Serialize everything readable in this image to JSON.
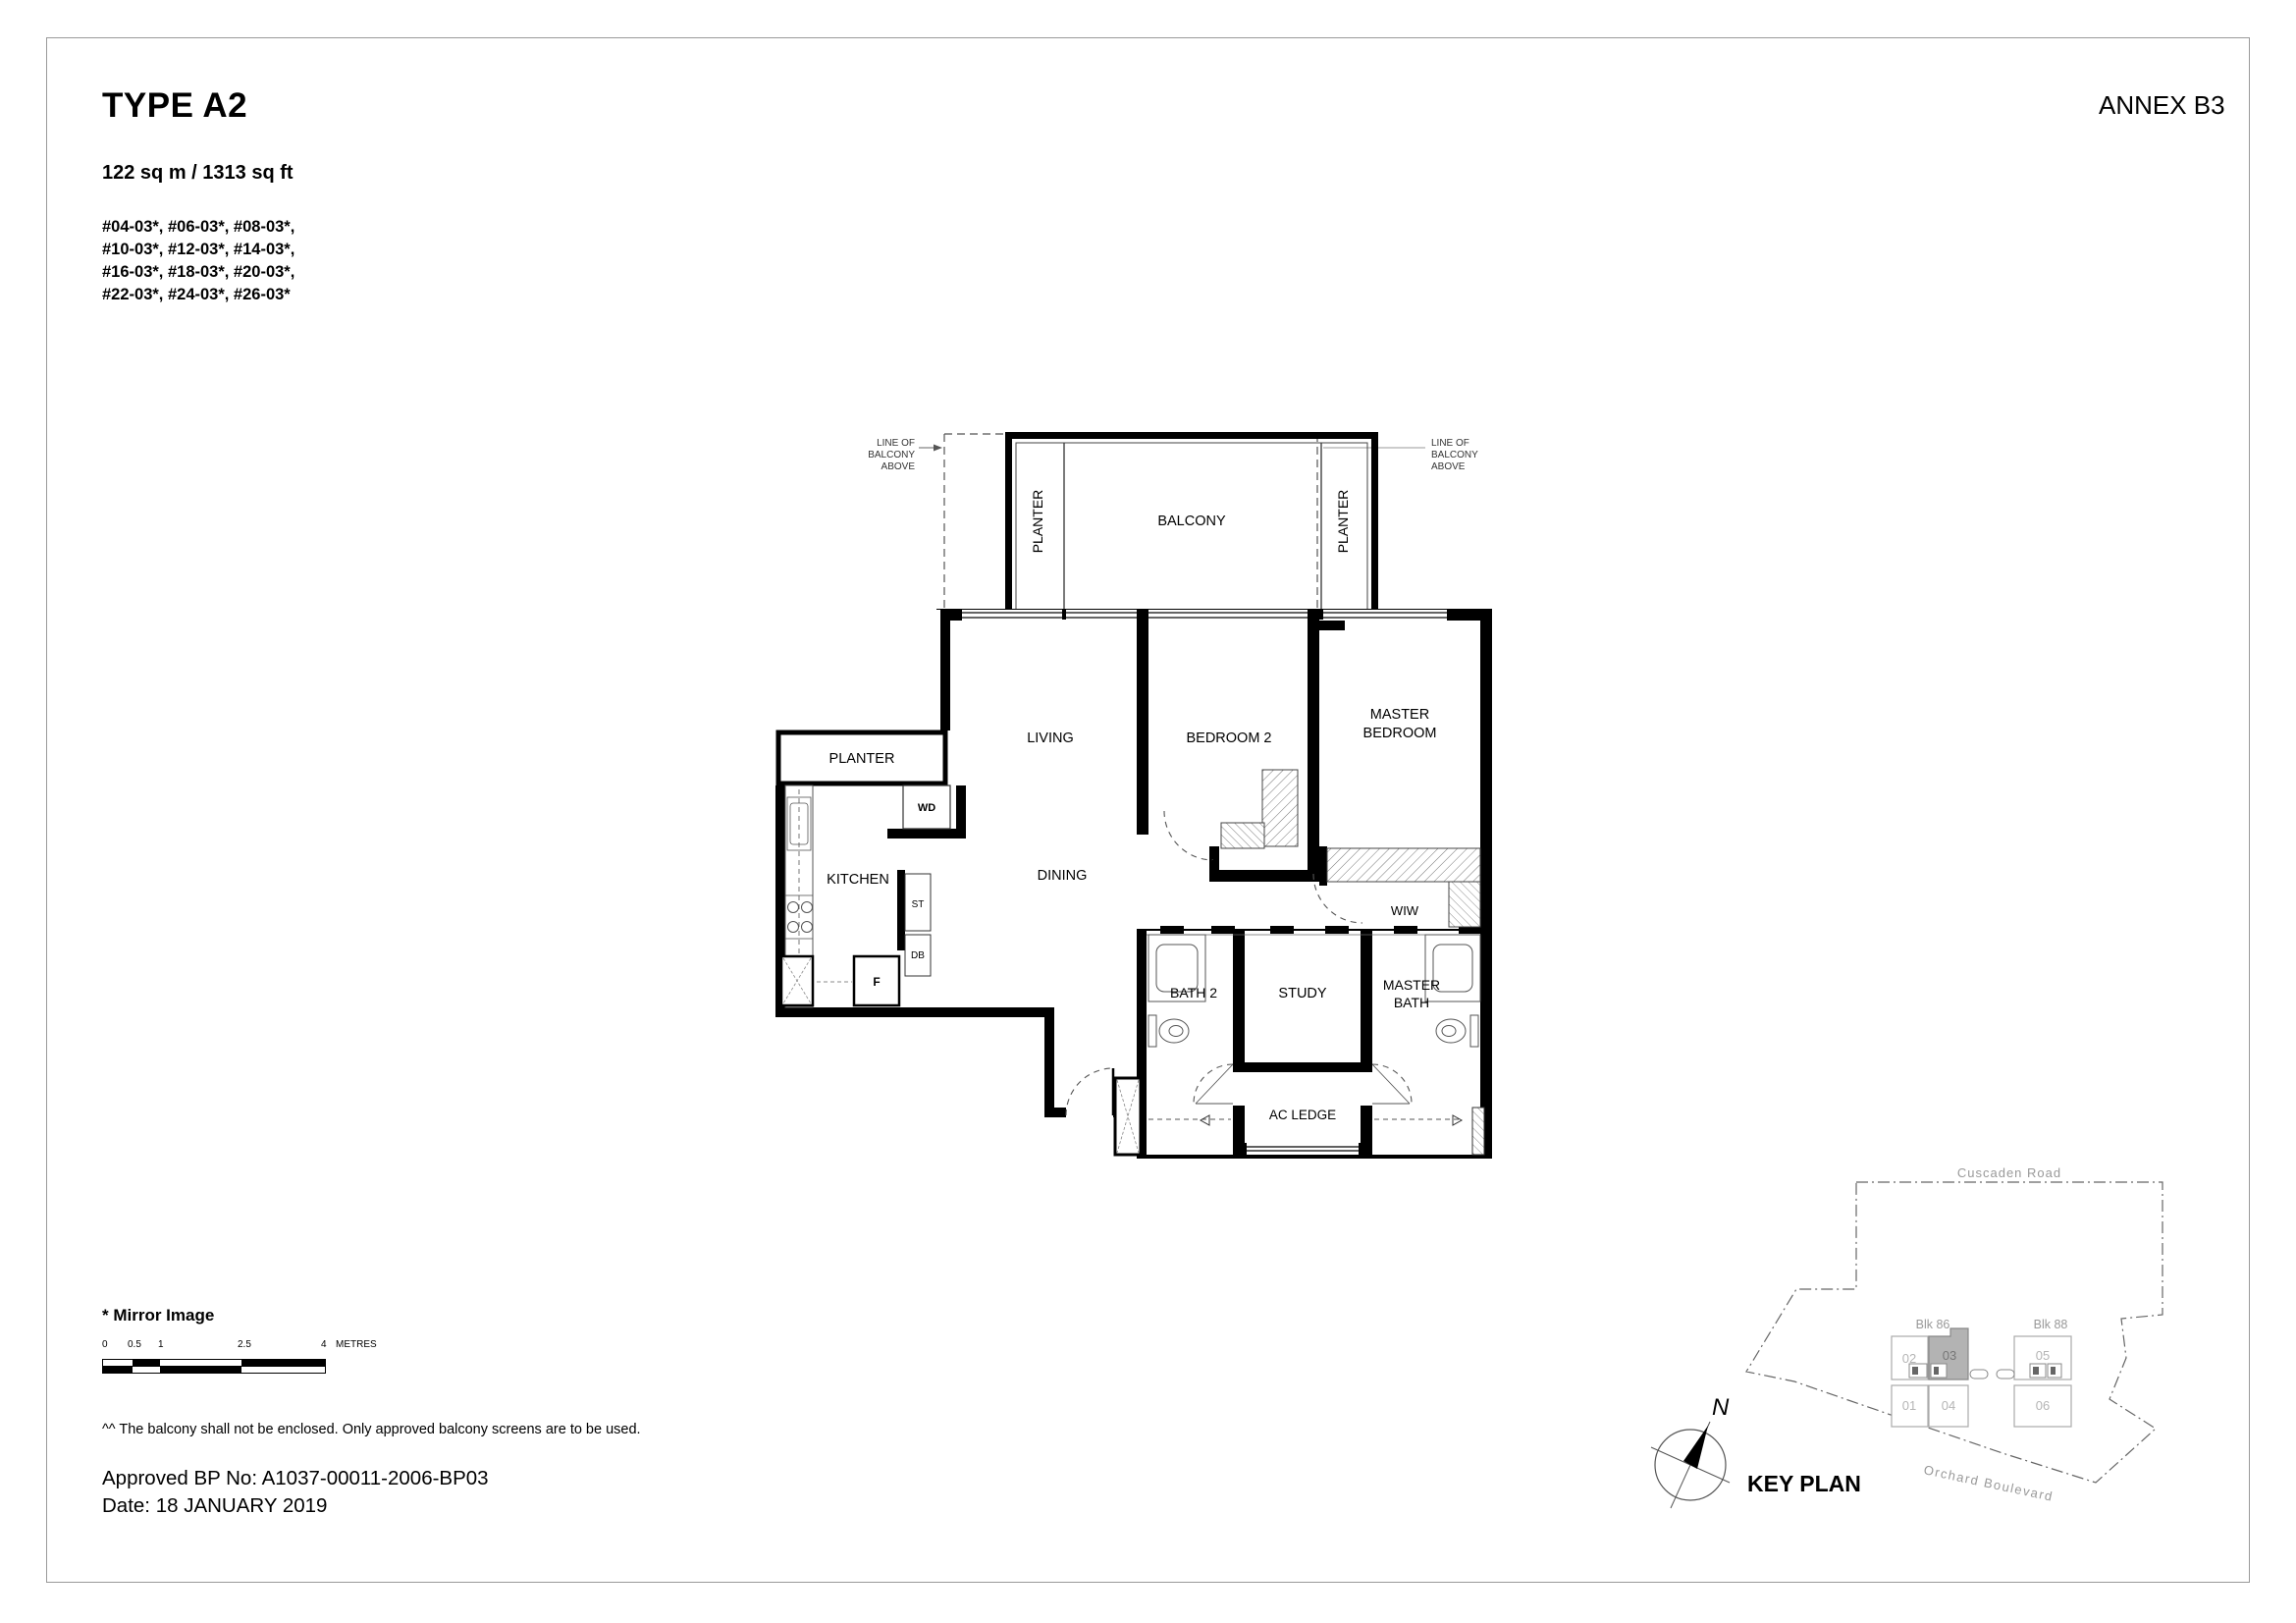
{
  "header": {
    "type_title": "TYPE A2",
    "annex": "ANNEX B3",
    "area": "122 sq m / 1313 sq ft",
    "unit_lines": [
      "#04-03*, #06-03*, #08-03*,",
      "#10-03*, #12-03*, #14-03*,",
      "#16-03*, #18-03*, #20-03*,",
      "#22-03*, #24-03*, #26-03*"
    ]
  },
  "plan": {
    "loba": {
      "l1": "LINE OF",
      "l2": "BALCONY",
      "l3": "ABOVE"
    },
    "balcony": "BALCONY",
    "planter_left_vertical": "PLANTER",
    "planter_right_vertical": "PLANTER",
    "planter_horizontal": "PLANTER",
    "rooms": {
      "living": "LIVING",
      "dining": "DINING",
      "kitchen": "KITCHEN",
      "bedroom2": "BEDROOM 2",
      "master_1": "MASTER",
      "master_2": "BEDROOM",
      "wiw": "WIW",
      "bath2": "BATH 2",
      "study": "STUDY",
      "mbath_1": "MASTER",
      "mbath_2": "BATH",
      "ac_ledge": "AC LEDGE"
    },
    "fixtures": {
      "wd": "WD",
      "st": "ST",
      "db": "DB",
      "f": "F"
    }
  },
  "scalebar": {
    "t0": "0",
    "t1": "0.5",
    "t2": "1",
    "t3": "2.5",
    "t4": "4",
    "unit": "METRES"
  },
  "notes": {
    "mirror": "* Mirror Image",
    "balcony": "^^ The balcony shall not be enclosed. Only approved balcony screens are to be used.",
    "bp": "Approved BP No: A1037-00011-2006-BP03",
    "date": "Date: 18 JANUARY 2019"
  },
  "keyplan": {
    "title": "KEY PLAN",
    "north": "N",
    "road_top": "Cuscaden Road",
    "road_bottom": "Orchard Boulevard",
    "blk86": "Blk 86",
    "blk88": "Blk 88",
    "u01": "01",
    "u02": "02",
    "u03": "03",
    "u04": "04",
    "u05": "05",
    "u06": "06",
    "highlight_color": "#b3b3b3"
  }
}
